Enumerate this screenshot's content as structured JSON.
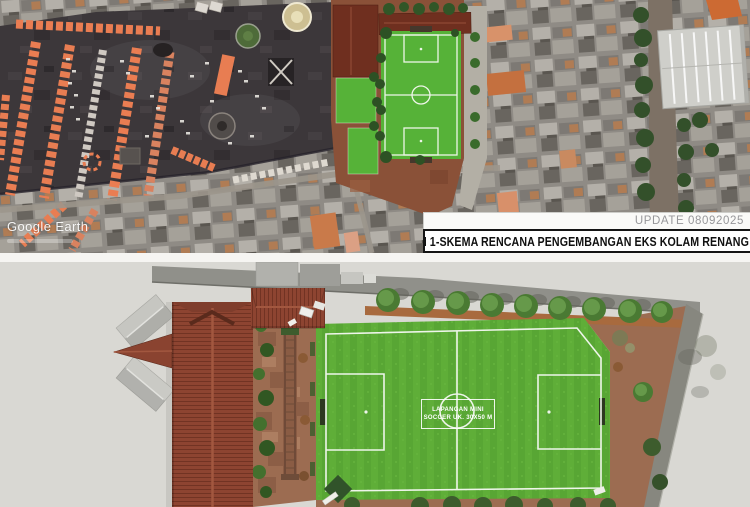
{
  "top_panel": {
    "watermark": "Google Earth",
    "update_label": "UPDATE 08092025",
    "title": "OPSI 1-SKEMA RENCANA PENGEMBANGAN EKS KOLAM RENANG THR"
  },
  "bottom_panel": {
    "field_label": {
      "line1": "LAPANGAN MINI",
      "line2": "SOCCER UK. 30X50 M"
    }
  },
  "colors": {
    "field_green": "#5fae38",
    "plan_field_green": "#56b238",
    "paving_brown": "#9c6c51",
    "overlay_paving": "#8a5138",
    "roof_terracotta": "#8d4431",
    "dark_roof_red": "#6f2f1f",
    "tent_orange": "#e87d52",
    "asphalt": "#3c373a",
    "panel_background": "#d9d8d3",
    "road_gray": "#90908a"
  }
}
